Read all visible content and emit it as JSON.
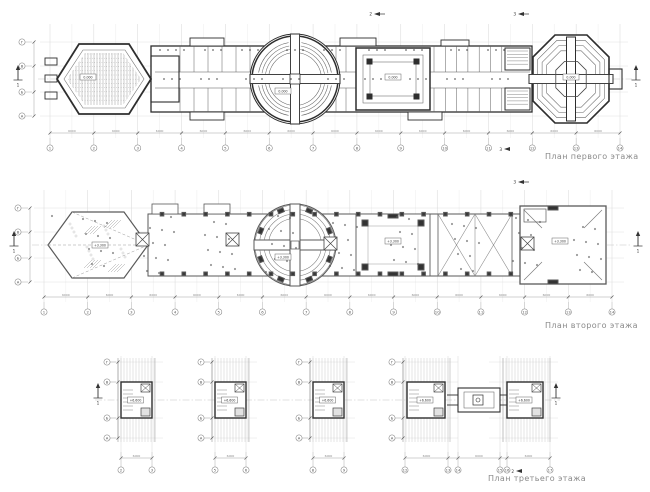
{
  "page": {
    "bg": "#ffffff",
    "ink": "#2e2e2e",
    "ink_medium": "#5a5a5a",
    "ink_light": "#8a8a8a",
    "grid_color": "#d2d2d2",
    "hatch_color": "#b8b8b8",
    "caption_color": "#8a8a8a"
  },
  "captions": {
    "first": "План первого этажа",
    "second": "План второго этажа",
    "third": "План третьего этажа"
  },
  "axes": {
    "numbers": [
      "1",
      "2",
      "3",
      "4",
      "5",
      "6",
      "7",
      "8",
      "9",
      "10",
      "11",
      "12",
      "13",
      "14"
    ],
    "letters": [
      "Г",
      "В",
      "Б",
      "А"
    ],
    "plan3_block1": [
      "2",
      "3"
    ],
    "plan3_block2": [
      "5",
      "6"
    ],
    "plan3_block3": [
      "8",
      "9"
    ],
    "plan3_block4": [
      "12",
      "13",
      "14",
      "15",
      "16",
      "17"
    ]
  },
  "dimensions": {
    "typical": "6000"
  },
  "elevations": {
    "first": "0.000",
    "second": "+3.300",
    "third": "+6.600"
  },
  "section_markers": {
    "one": "1",
    "two": "2",
    "three": "3"
  }
}
